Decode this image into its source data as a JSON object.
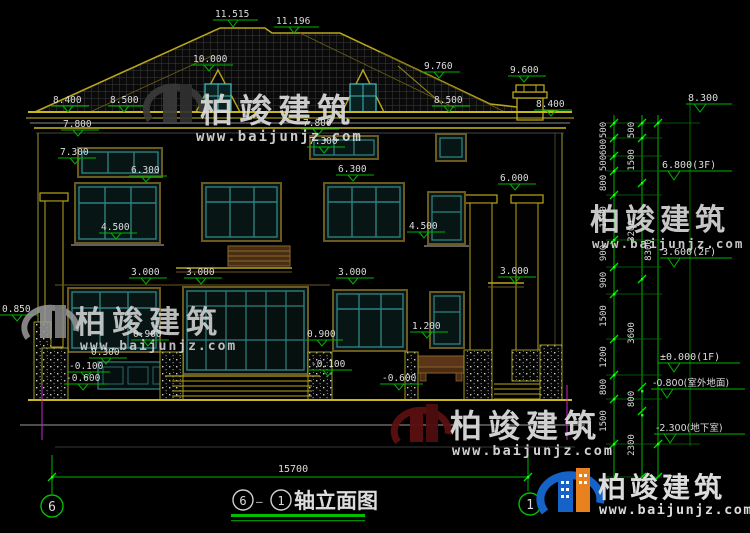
{
  "drawing": {
    "title": {
      "axis_from": "6",
      "dash": "—",
      "axis_to": "1",
      "name": "轴立面图"
    },
    "axis_bubbles": {
      "left": "6",
      "right": "1"
    },
    "total_width_dim": "15700",
    "total_height_dim": "8300"
  },
  "levels": {
    "ridge_main": "11.515",
    "ridge_upper": "11.196",
    "dormer_top": "10.000",
    "roof_hip": "9.760",
    "chimney_top": "9.600",
    "eave_left": "8.400",
    "roof_left": "8.500",
    "roof_right": "8.500",
    "eave_right": "8.400",
    "left_7800": "7.800",
    "left_7300": "7.300",
    "center_7800": "7.800",
    "center_7300": "7.300",
    "left_6300": "6.300",
    "center_6300": "6.300",
    "right_6000": "6.000",
    "left_4500": "4.500",
    "center_4500": "4.500",
    "left_3000_a": "3.000",
    "left_3000_b": "3.000",
    "center_3000": "3.000",
    "right_3000": "3.000",
    "left_0850": "0.850",
    "left_0900": "0.900",
    "center_0900": "0.900",
    "right_1200": "1.200",
    "left_0300": "0.300",
    "left_m0100": "-0.100",
    "center_m0100": "-0.100",
    "left_m0600": "-0.600",
    "center_m0600": "-0.600",
    "right_8300": "8.300",
    "right_6800": "6.800(3F)",
    "right_3600": "3.600(2F)",
    "right_0000": "±0.000(1F)",
    "right_m0800": "-0.800(室外地面)",
    "right_m2300": "-2.300(地下室)"
  },
  "dims": {
    "chain_a": [
      "500",
      "600",
      "500",
      "800",
      "1500",
      "900",
      "900",
      "1500",
      "1200",
      "800",
      "1500"
    ],
    "chain_b": [
      "500",
      "1500",
      "3200",
      "3600",
      "800",
      "2300"
    ]
  },
  "watermark": {
    "brand": "柏竣建筑",
    "url": "www.baijunjz.com"
  },
  "logo": {
    "brand": "柏竣建筑",
    "url": "www.baijunjz.com"
  },
  "colors": {
    "dim_green": "#00b400",
    "cad_yellow": "#b9a51c",
    "frame_teal": "#2e8080",
    "watermark_red": "#6e1111",
    "logo_blue": "#1663c7",
    "logo_orange": "#e8821e",
    "magenta": "#c928c9"
  }
}
